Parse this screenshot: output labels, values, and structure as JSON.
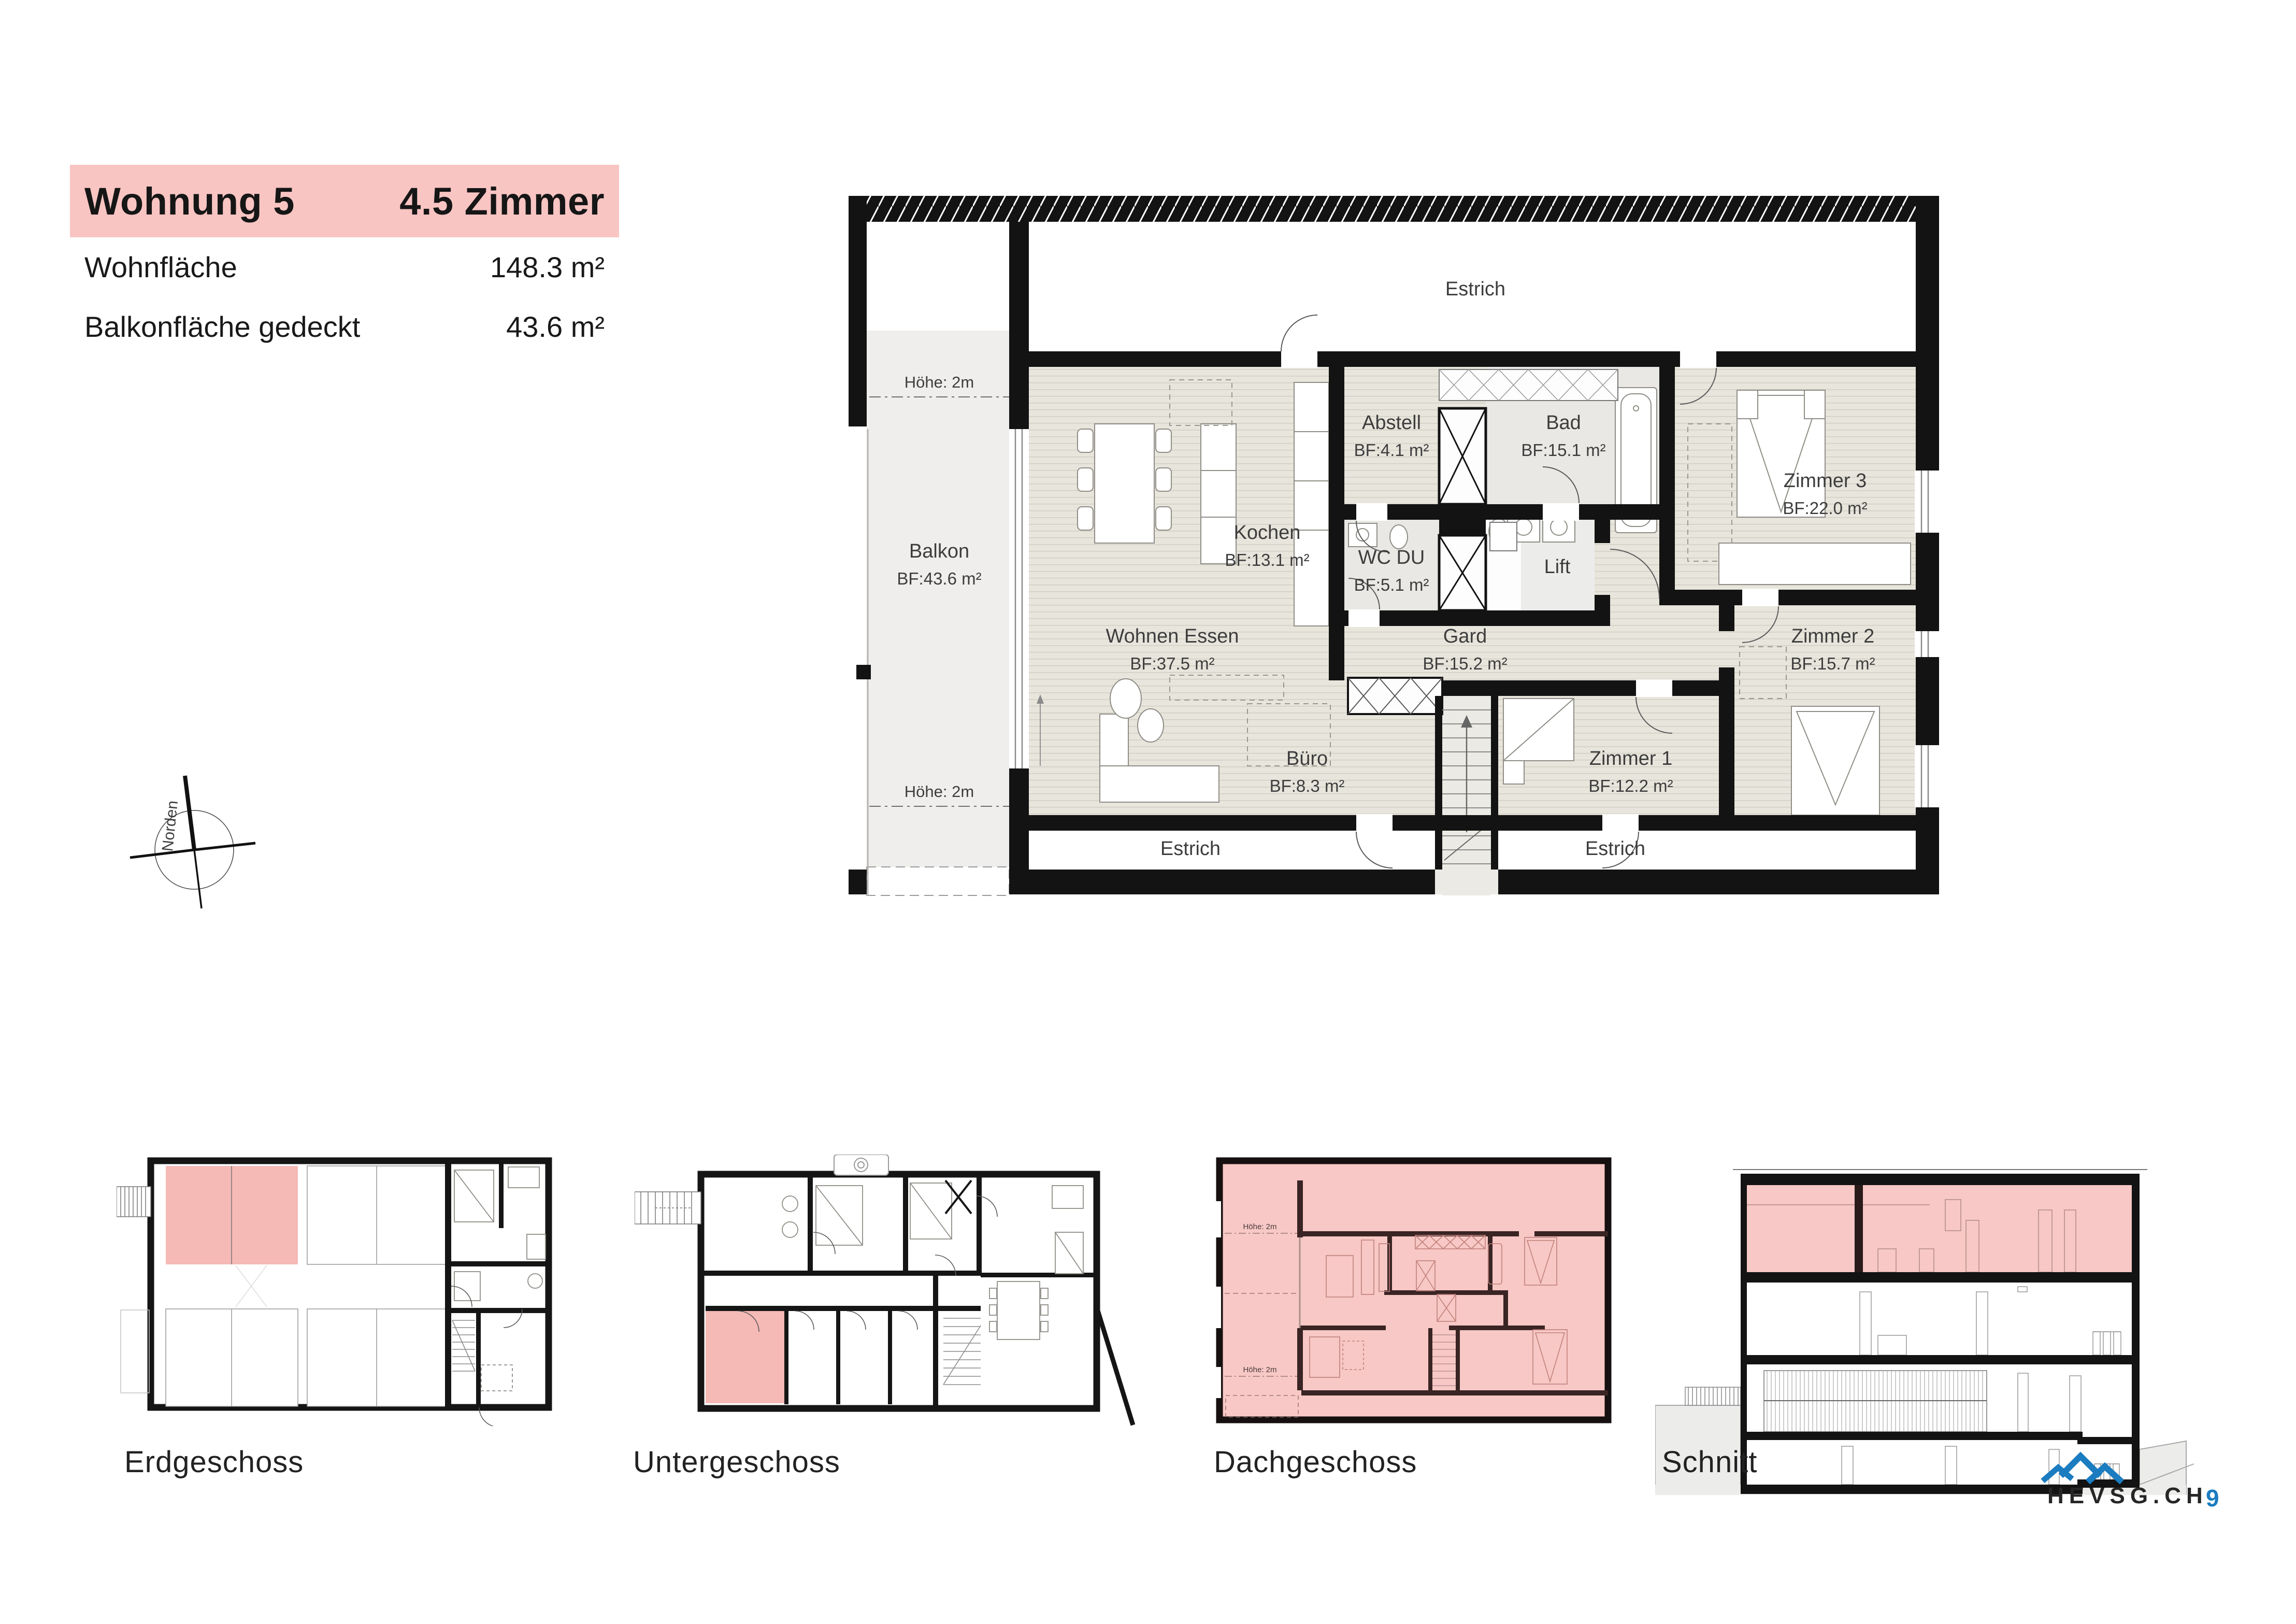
{
  "header": {
    "title": "Wohnung 5",
    "subtitle": "4.5 Zimmer",
    "rows": [
      {
        "label": "Wohnfläche",
        "value": "148.3 m²"
      },
      {
        "label": "Balkonfläche gedeckt",
        "value": "43.6 m²"
      }
    ]
  },
  "compass": {
    "north_label": "Norden"
  },
  "main_plan": {
    "estrich_top": "Estrich",
    "estrich_bottom_left": "Estrich",
    "estrich_bottom_right": "Estrich",
    "hoehe_top": "Höhe: 2m",
    "hoehe_bottom": "Höhe: 2m",
    "balkon": {
      "name": "Balkon",
      "area": "BF:43.6 m²"
    },
    "lift_label": "Lift",
    "rooms": [
      {
        "name": "Abstell",
        "area": "BF:4.1 m²"
      },
      {
        "name": "Bad",
        "area": "BF:15.1 m²"
      },
      {
        "name": "Zimmer 3",
        "area": "BF:22.0 m²"
      },
      {
        "name": "Kochen",
        "area": "BF:13.1 m²"
      },
      {
        "name": "WC DU",
        "area": "BF:5.1 m²"
      },
      {
        "name": "Wohnen Essen",
        "area": "BF:37.5 m²"
      },
      {
        "name": "Gard",
        "area": "BF:15.2 m²"
      },
      {
        "name": "Zimmer 2",
        "area": "BF:15.7 m²"
      },
      {
        "name": "Büro",
        "area": "BF:8.3 m²"
      },
      {
        "name": "Zimmer 1",
        "area": "BF:12.2 m²"
      }
    ]
  },
  "thumbnails": {
    "dach_hoehe_top": "Höhe: 2m",
    "dach_hoehe_bottom": "Höhe: 2m"
  },
  "floors": [
    {
      "label": "Erdgeschoss"
    },
    {
      "label": "Untergeschoss"
    },
    {
      "label": "Dachgeschoss"
    },
    {
      "label": "Schnitt"
    }
  ],
  "footer": {
    "logo_text": "HEVSG.CH",
    "page_number": "9"
  },
  "colors": {
    "accent_pink": "#f8c5c3",
    "plan_pink": "#f7c8c5",
    "logo_blue": "#1b7cc0",
    "wall_black": "#131313",
    "wood_floor": "#e7e5dc",
    "gray_room": "#e9e8e5"
  }
}
